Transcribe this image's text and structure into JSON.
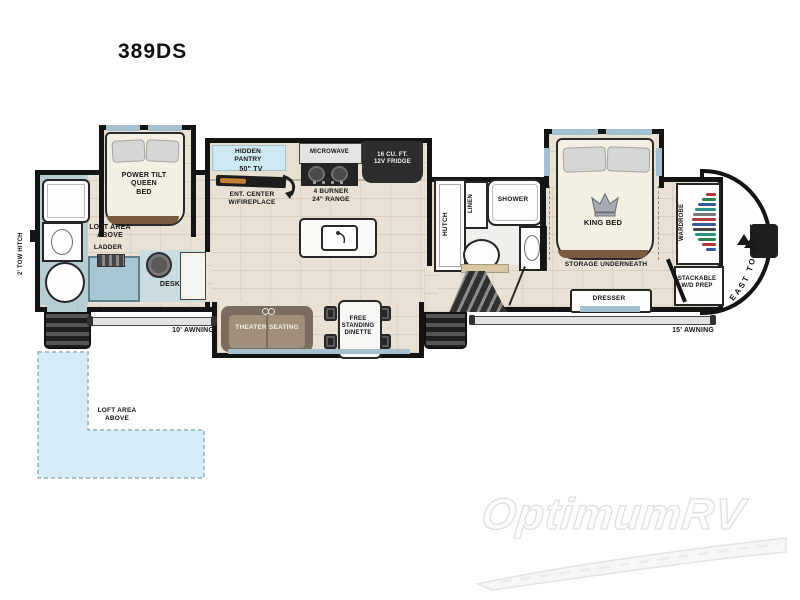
{
  "title": "389DS",
  "brand_logo": "EAST TO WEST",
  "watermark": "OptimumRV",
  "exterior": {
    "tow_hitch": "2' TOW HITCH",
    "awning_front": "10' AWNING",
    "awning_rear": "15' AWNING"
  },
  "front_bedroom": {
    "bed": "POWER TILT\nQUEEN\nBED",
    "loft": "LOFT AREA\nABOVE",
    "ladder": "LADDER",
    "desk": "DESK"
  },
  "kitchen": {
    "pantry": "HIDDEN\nPANTRY",
    "tv": "50\" TV",
    "ent_center": "ENT. CENTER\nW/FIREPLACE",
    "microwave": "MICROWAVE",
    "range": "4 BURNER\n24\" RANGE",
    "fridge": "16 CU. FT.\n12V FRIDGE"
  },
  "living": {
    "theater_seating": "THEATER SEATING",
    "dinette": "FREE\nSTANDING\nDINETTE",
    "hutch": "HUTCH"
  },
  "bathroom": {
    "linen": "LINEN",
    "shower": "SHOWER"
  },
  "rear_bedroom": {
    "king_bed": "KING BED",
    "storage": "STORAGE UNDERNEATH",
    "wardrobe": "WARDROBE",
    "dresser": "DRESSER",
    "wd_prep": "STACKABLE\nW/D PREP"
  },
  "loft_area": "LOFT AREA\nABOVE",
  "colors": {
    "wall": "#141414",
    "floor": "#e9e2d4",
    "bath_floor": "#b6cdd2",
    "desk_floor": "#c9dce0",
    "pantry_fill": "#cfe9f2",
    "loft_fill": "#d6edf9",
    "theater_brown": "#7c6c5d",
    "appliance_dark": "#2c2c2c"
  }
}
